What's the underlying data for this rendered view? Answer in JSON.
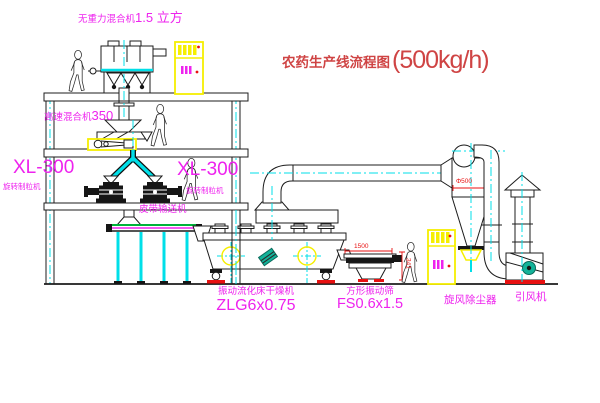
{
  "title": {
    "text": "农药生产线流程图",
    "capacity": "(500kg/h)"
  },
  "labels": {
    "gravity_mixer_name": "无重力混合机",
    "gravity_mixer_size": "1.5 立方",
    "high_speed_mixer_name": "高速混合机",
    "high_speed_mixer_model": "350",
    "granulator_left_model": "XL-300",
    "granulator_left_name": "旋转制粒机",
    "granulator_right_model": "XL-300",
    "granulator_right_name": "旋转制粒机",
    "belt_conveyor": "皮带输送机",
    "fluid_bed_dryer_name": "振动流化床干燥机",
    "fluid_bed_dryer_model": "ZLG6x0.75",
    "square_sieve_name": "方形振动筛",
    "square_sieve_model": "FS0.6x1.5",
    "cyclone_collector": "旋风除尘器",
    "induced_draft_fan": "引风机"
  },
  "dimensions": {
    "cyclone_diameter": "Φ500",
    "sieve_length": "1500",
    "sieve_height": "341"
  },
  "colors": {
    "label_magenta": "#ee22ee",
    "title_red": "#cf4444",
    "dimension_red": "#e81111",
    "pipe_cyan": "#00dfe8",
    "highlight_yellow": "#f6ef00",
    "conveyor_green": "#00b33c",
    "motor_teal": "#13b39a",
    "linework_black": "#1c1c1c",
    "background": "#ffffff"
  }
}
